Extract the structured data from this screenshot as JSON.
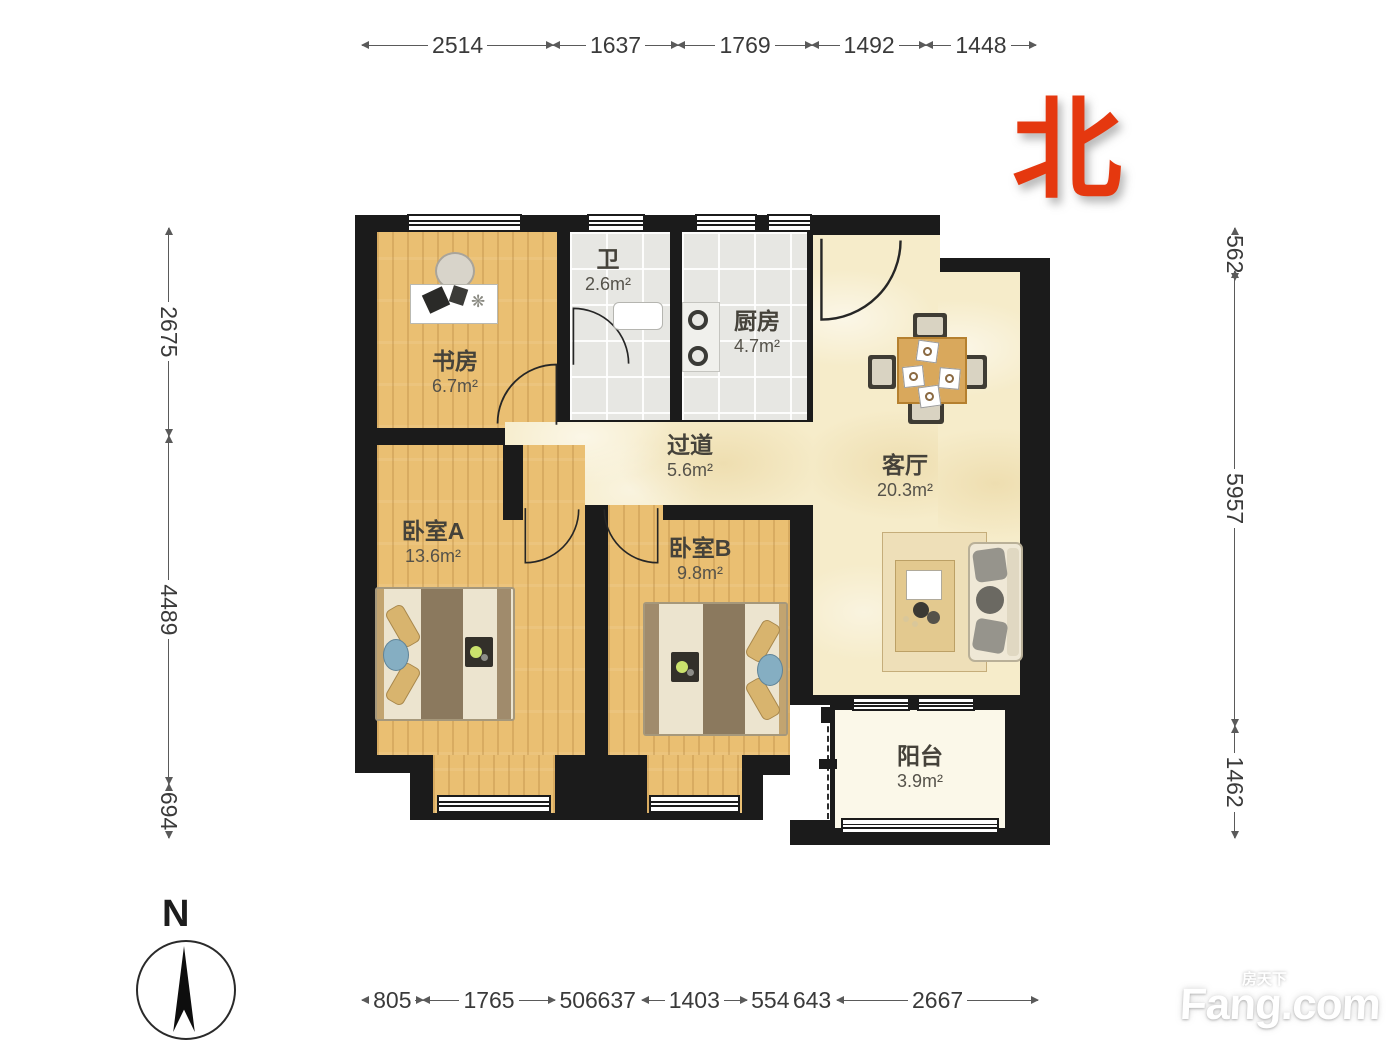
{
  "north": {
    "char": "北"
  },
  "compass": {
    "label": "N"
  },
  "watermark": {
    "cn": "房天下",
    "en": "Fang.com"
  },
  "dims": {
    "top": [
      "2514",
      "1637",
      "1769",
      "1492",
      "1448"
    ],
    "left": [
      "2675",
      "4489",
      "694"
    ],
    "right": [
      "562",
      "5957",
      "1462"
    ],
    "bottom": [
      "805",
      "1765",
      "506",
      "637",
      "1403",
      "554",
      "643",
      "2667"
    ]
  },
  "rooms": {
    "study": {
      "name": "书房",
      "area": "6.7m²"
    },
    "bath": {
      "name": "卫",
      "area": "2.6m²"
    },
    "kitchen": {
      "name": "厨房",
      "area": "4.7m²"
    },
    "hallway": {
      "name": "过道",
      "area": "5.6m²"
    },
    "living": {
      "name": "客厅",
      "area": "20.3m²"
    },
    "bedroom_a": {
      "name": "卧室A",
      "area": "13.6m²"
    },
    "bedroom_b": {
      "name": "卧室B",
      "area": "9.8m²"
    },
    "balcony": {
      "name": "阳台",
      "area": "3.9m²"
    }
  },
  "colors": {
    "wall": "#1b1b1b",
    "wood_floor": "#eabf72",
    "tile_floor": "#e7e7e3",
    "living_floor": "#f6ecca",
    "balcony_floor": "#fbf8e9",
    "north_red": "#e5380f"
  }
}
